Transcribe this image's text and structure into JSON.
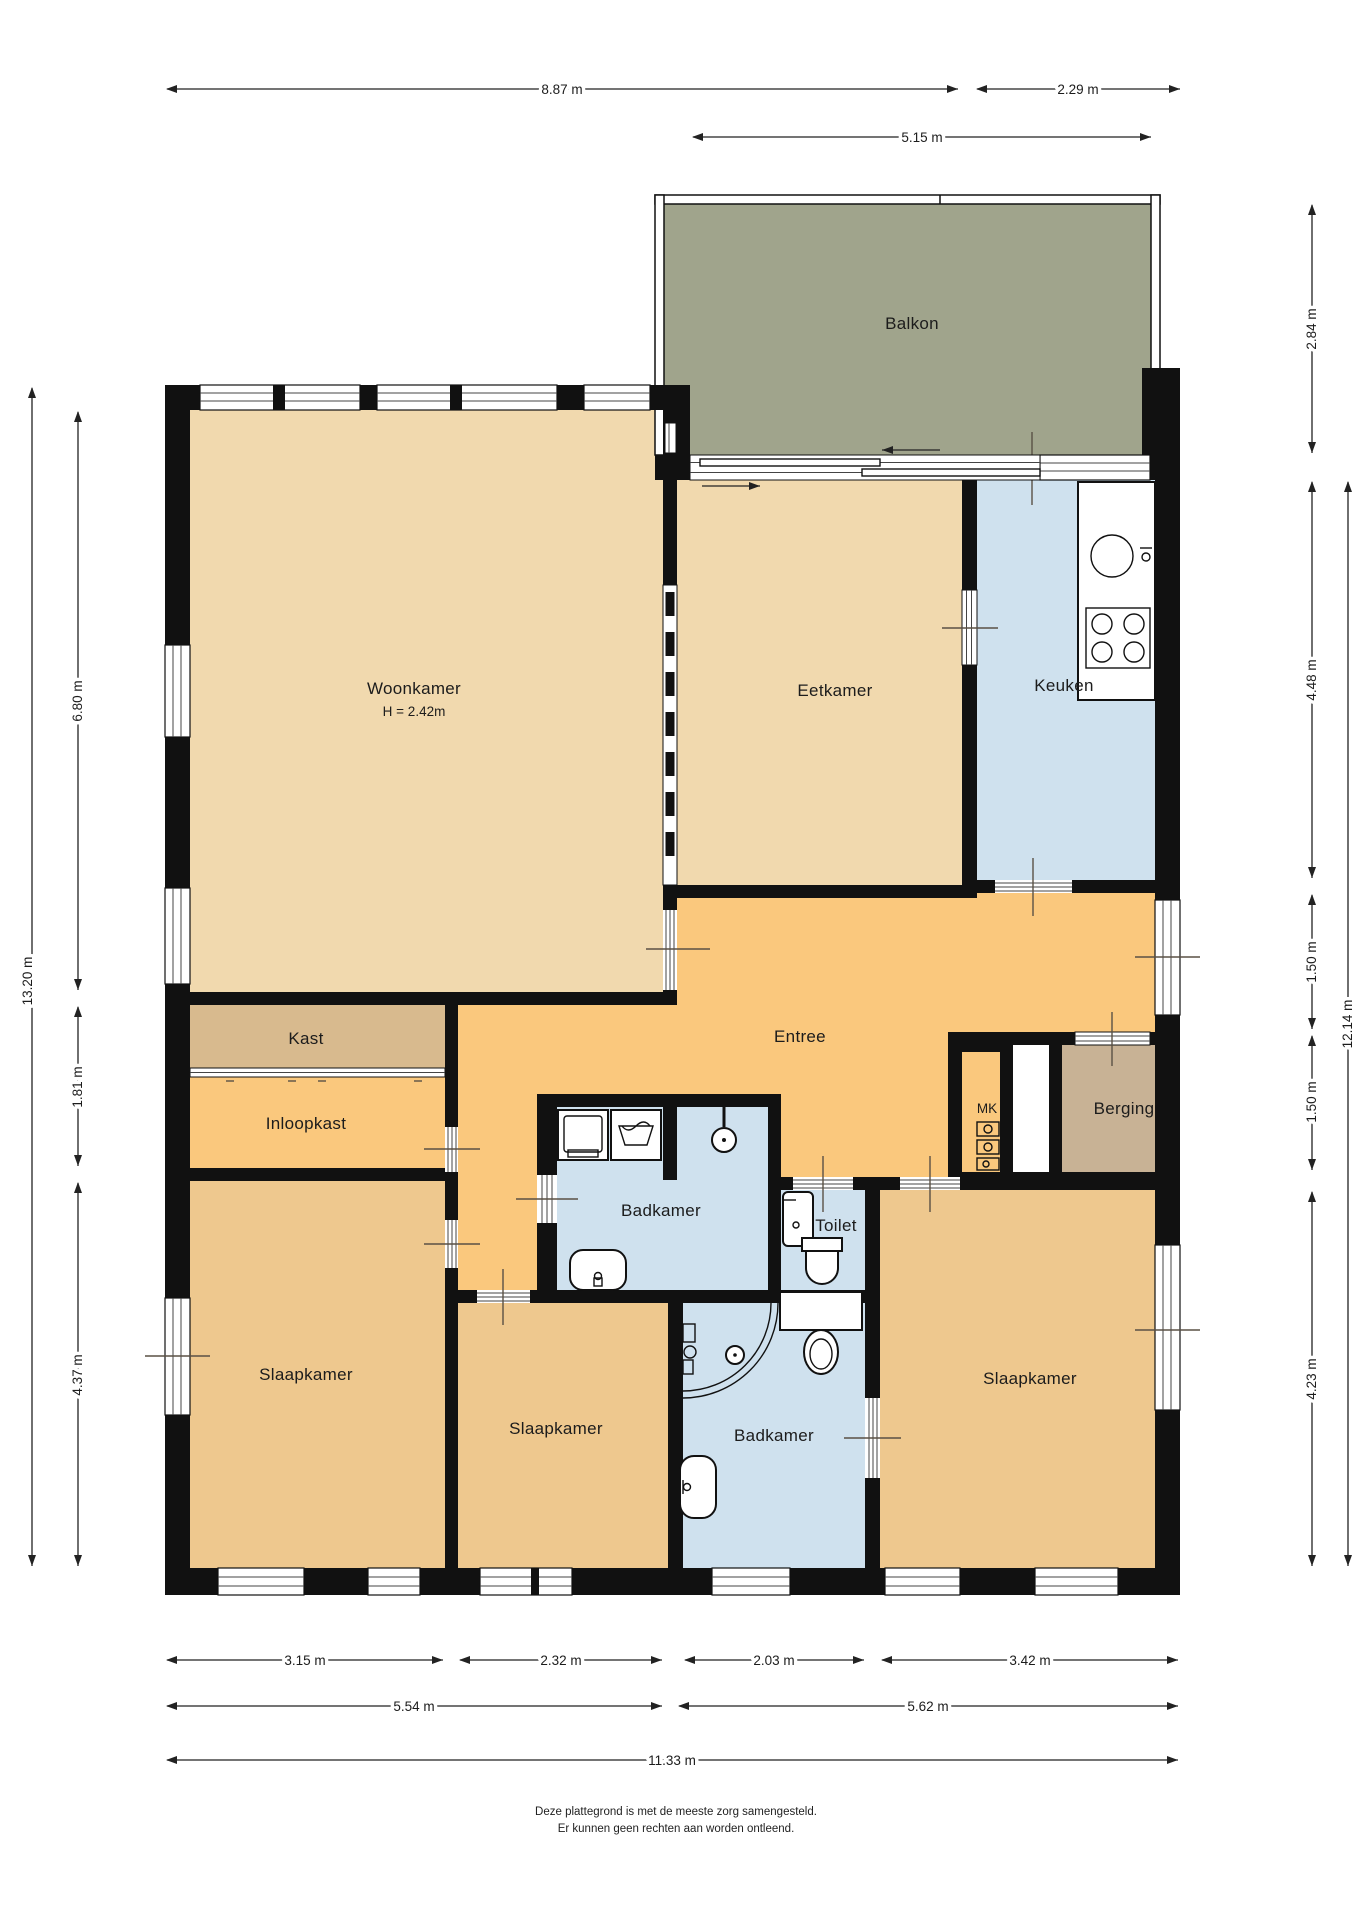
{
  "rooms": {
    "balkon": {
      "label": "Balkon"
    },
    "woonkamer": {
      "label": "Woonkamer",
      "height_note": "H = 2.42m"
    },
    "eetkamer": {
      "label": "Eetkamer"
    },
    "keuken": {
      "label": "Keuken"
    },
    "entree": {
      "label": "Entree"
    },
    "kast": {
      "label": "Kast"
    },
    "inloopkast": {
      "label": "Inloopkast"
    },
    "mk": {
      "label": "MK"
    },
    "berging": {
      "label": "Berging"
    },
    "badkamer_top": {
      "label": "Badkamer"
    },
    "toilet": {
      "label": "Toilet"
    },
    "slaapkamer_left": {
      "label": "Slaapkamer"
    },
    "slaapkamer_mid": {
      "label": "Slaapkamer"
    },
    "badkamer_bottom": {
      "label": "Badkamer"
    },
    "slaapkamer_right": {
      "label": "Slaapkamer"
    }
  },
  "dims": {
    "d887": "8.87 m",
    "d229": "2.29 m",
    "d515": "5.15 m",
    "d1320": "13.20 m",
    "d680": "6.80 m",
    "d181": "1.81 m",
    "d437": "4.37 m",
    "d284": "2.84 m",
    "d448": "4.48 m",
    "d150a": "1.50 m",
    "d150b": "1.50 m",
    "d423": "4.23 m",
    "d1214": "12.14 m",
    "d315": "3.15 m",
    "d232": "2.32 m",
    "d203": "2.03 m",
    "d342": "3.42 m",
    "d554": "5.54 m",
    "d562": "5.62 m",
    "d1133": "11.33 m"
  },
  "footer": {
    "line1": "Deze plattegrond is met de meeste zorg samengesteld.",
    "line2": "Er kunnen geen rechten aan worden ontleend."
  },
  "colors": {
    "wall": "#111111",
    "balkon": "#a0a48c",
    "living": "#f1d9ae",
    "hall": "#fac87d",
    "wet": "#cfe1ee",
    "kast": "#d8ba8e",
    "berging": "#c8b295",
    "bedroom": "#eec88e"
  }
}
